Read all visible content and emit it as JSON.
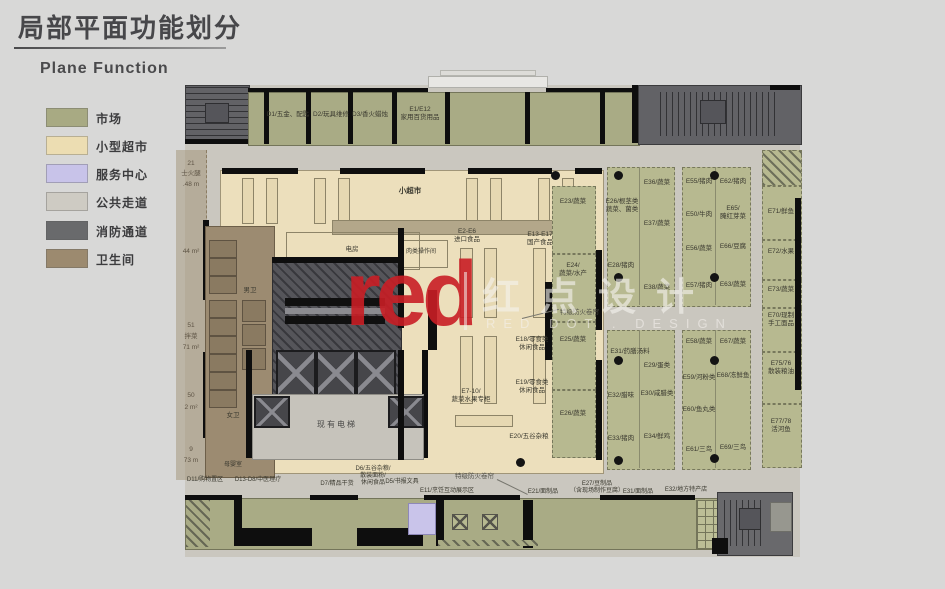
{
  "page": {
    "title": "局部平面功能划分",
    "subtitle": "Plane Function"
  },
  "legend": {
    "items": [
      {
        "label": "市场",
        "color": "#a8aa83"
      },
      {
        "label": "小型超市",
        "color": "#ecddb2"
      },
      {
        "label": "服务中心",
        "color": "#c8c3e9"
      },
      {
        "label": "公共走道",
        "color": "#cecbc3"
      },
      {
        "label": "消防通道",
        "color": "#696a6c"
      },
      {
        "label": "卫生间",
        "color": "#9c8a6f"
      }
    ]
  },
  "watermark": {
    "logo": "red",
    "cn": "红点设计",
    "en": "RED DOT . DESIGN"
  },
  "plan": {
    "top": {
      "d1": "D1/五金、配匙",
      "d2": "D2/玩具维修",
      "d3": "D3/香火蜡烛",
      "e112": "E1/E12\n家用百货用品"
    },
    "west_outside": [
      "21",
      "士火腿",
      ".48 m",
      "44 m²",
      "51",
      "拌菜",
      "71 m²",
      "50",
      "2 m²",
      "9",
      "73 m"
    ],
    "center": {
      "supermarket": "小超市",
      "power": "电房",
      "existing_elevator": "现有电梯",
      "men": "男卫",
      "women": "女卫",
      "nursery": "母婴室",
      "meat_prep": "肉类操作间",
      "imported": "E2-E6\n进口食品",
      "domestic": "E13-E17\n国产食品",
      "produce": "E7-10/\n蔬菜水果专柜",
      "snack1": "E18/零食类\n休闲食品",
      "snack2": "E19/零食类\n休闲食品",
      "grain": "E20/五谷杂粮"
    },
    "east_edge": [
      "E23/蔬菜",
      "E24/\n蔬菜/水产",
      "E25/蔬菜",
      "E26/蔬菜"
    ],
    "market_g1a": [
      "E36/蔬菜",
      "E26/根茎类\n蔬菜、菌类",
      "E37/蔬菜",
      "E28/猪肉",
      "E38/蔬菜"
    ],
    "market_g1b": [
      "E31/药膳汤料",
      "E29/蛋类",
      "E32/腊味",
      "E30/咸腊类",
      "E33/猪肉",
      "E34/鲜鸡"
    ],
    "market_g2a": [
      "E55/猪肉",
      "E62/猪肉",
      "E50/牛肉",
      "E65/\n腌红芽菜",
      "E56/蔬菜",
      "E66/豆腐",
      "E57/猪肉",
      "E63/蔬菜"
    ],
    "market_g2b": [
      "E58/蔬菜",
      "E67/蔬菜",
      "E59/河粉类",
      "E68/冻鲜鱼",
      "E60/鱼丸类",
      "E61/三鸟",
      "E69/三鸟"
    ],
    "east_col": [
      "E71/鲜鱼",
      "E72/水果",
      "E73/蔬菜",
      "E70/现制\n手工面品",
      "E75/76\n散装粮油",
      "E77/78\n活河鱼"
    ],
    "bottom": [
      "D11/购物置区",
      "D13-D8/中医理疗",
      "D7/精品干货",
      "D6/五谷杂粮/\n散装面粉/\n休闲食品",
      "D5/书报文具",
      "E11/烹饪互动展示区",
      "E21/面制品",
      "E27/豆制品\n（含现场制作豆腐）",
      "E31/面制品",
      "E32/地方特产店"
    ],
    "annotations": {
      "fire_shutter": "特级防火卷帘"
    }
  }
}
